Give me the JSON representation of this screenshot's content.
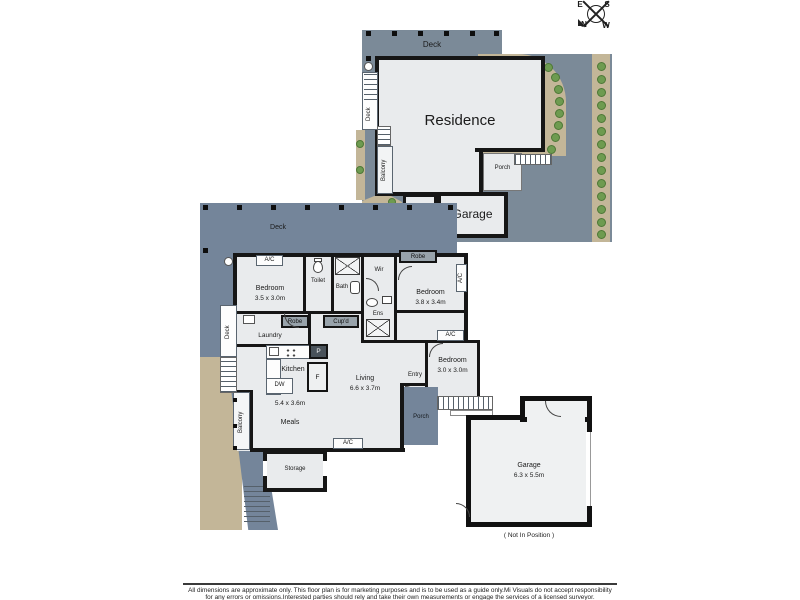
{
  "compass": {
    "east": "E",
    "south": "S",
    "north": "N",
    "west": "W"
  },
  "upper_plan": {
    "deck_top": "Deck",
    "deck_side": "Deck",
    "residence": "Residence",
    "balcony": "Balcony",
    "porch": "Porch",
    "store": "Store",
    "garage": "Garage"
  },
  "lower_plan": {
    "deck_top": "Deck",
    "deck_side": "Deck",
    "balcony": "Balcony",
    "bedroom1": {
      "name": "Bedroom",
      "dim": "3.5 x 3.0m",
      "ac": "A/C"
    },
    "toilet": "Toilet",
    "bath": "Bath",
    "wir": "Wir",
    "ens": "Ens",
    "bedroom2": {
      "name": "Bedroom",
      "dim": "3.8 x 3.4m",
      "robe": "Robe",
      "ac": "A/C"
    },
    "bedroom3": {
      "name": "Bedroom",
      "dim": "3.0 x 3.0m",
      "ac": "A/C"
    },
    "robe": "Robe",
    "cupd": "Cup'd",
    "laundry": "Laundry",
    "kitchen": {
      "name": "Kitchen",
      "dw": "DW",
      "pantry": "P",
      "fridge": "F"
    },
    "living": {
      "name": "Living",
      "dim": "6.6 x 3.7m"
    },
    "meals": {
      "name": "Meals",
      "dim": "5.4 x 3.6m"
    },
    "entry": "Entry",
    "porch": "Porch",
    "storage": "Storage",
    "ac_bottom": "A/C"
  },
  "detached_garage": {
    "name": "Garage",
    "dim": "6.3 x 5.5m",
    "note": "( Not In Position )"
  },
  "disclaimer": {
    "line1": "All dimensions are approximate only. This floor plan is for marketing purposes and is to be used as a guide only.Mi Visuals do not accept responsibility",
    "line2": "for any errors or omissions.Interested parties should rely and take their own measurements or engage the services of a licensed surveyor."
  },
  "colors": {
    "site": "#7b8a98",
    "room": "#e9ebed",
    "wall": "#161616",
    "path": "#c3b698",
    "tree": "#6e9b50"
  }
}
